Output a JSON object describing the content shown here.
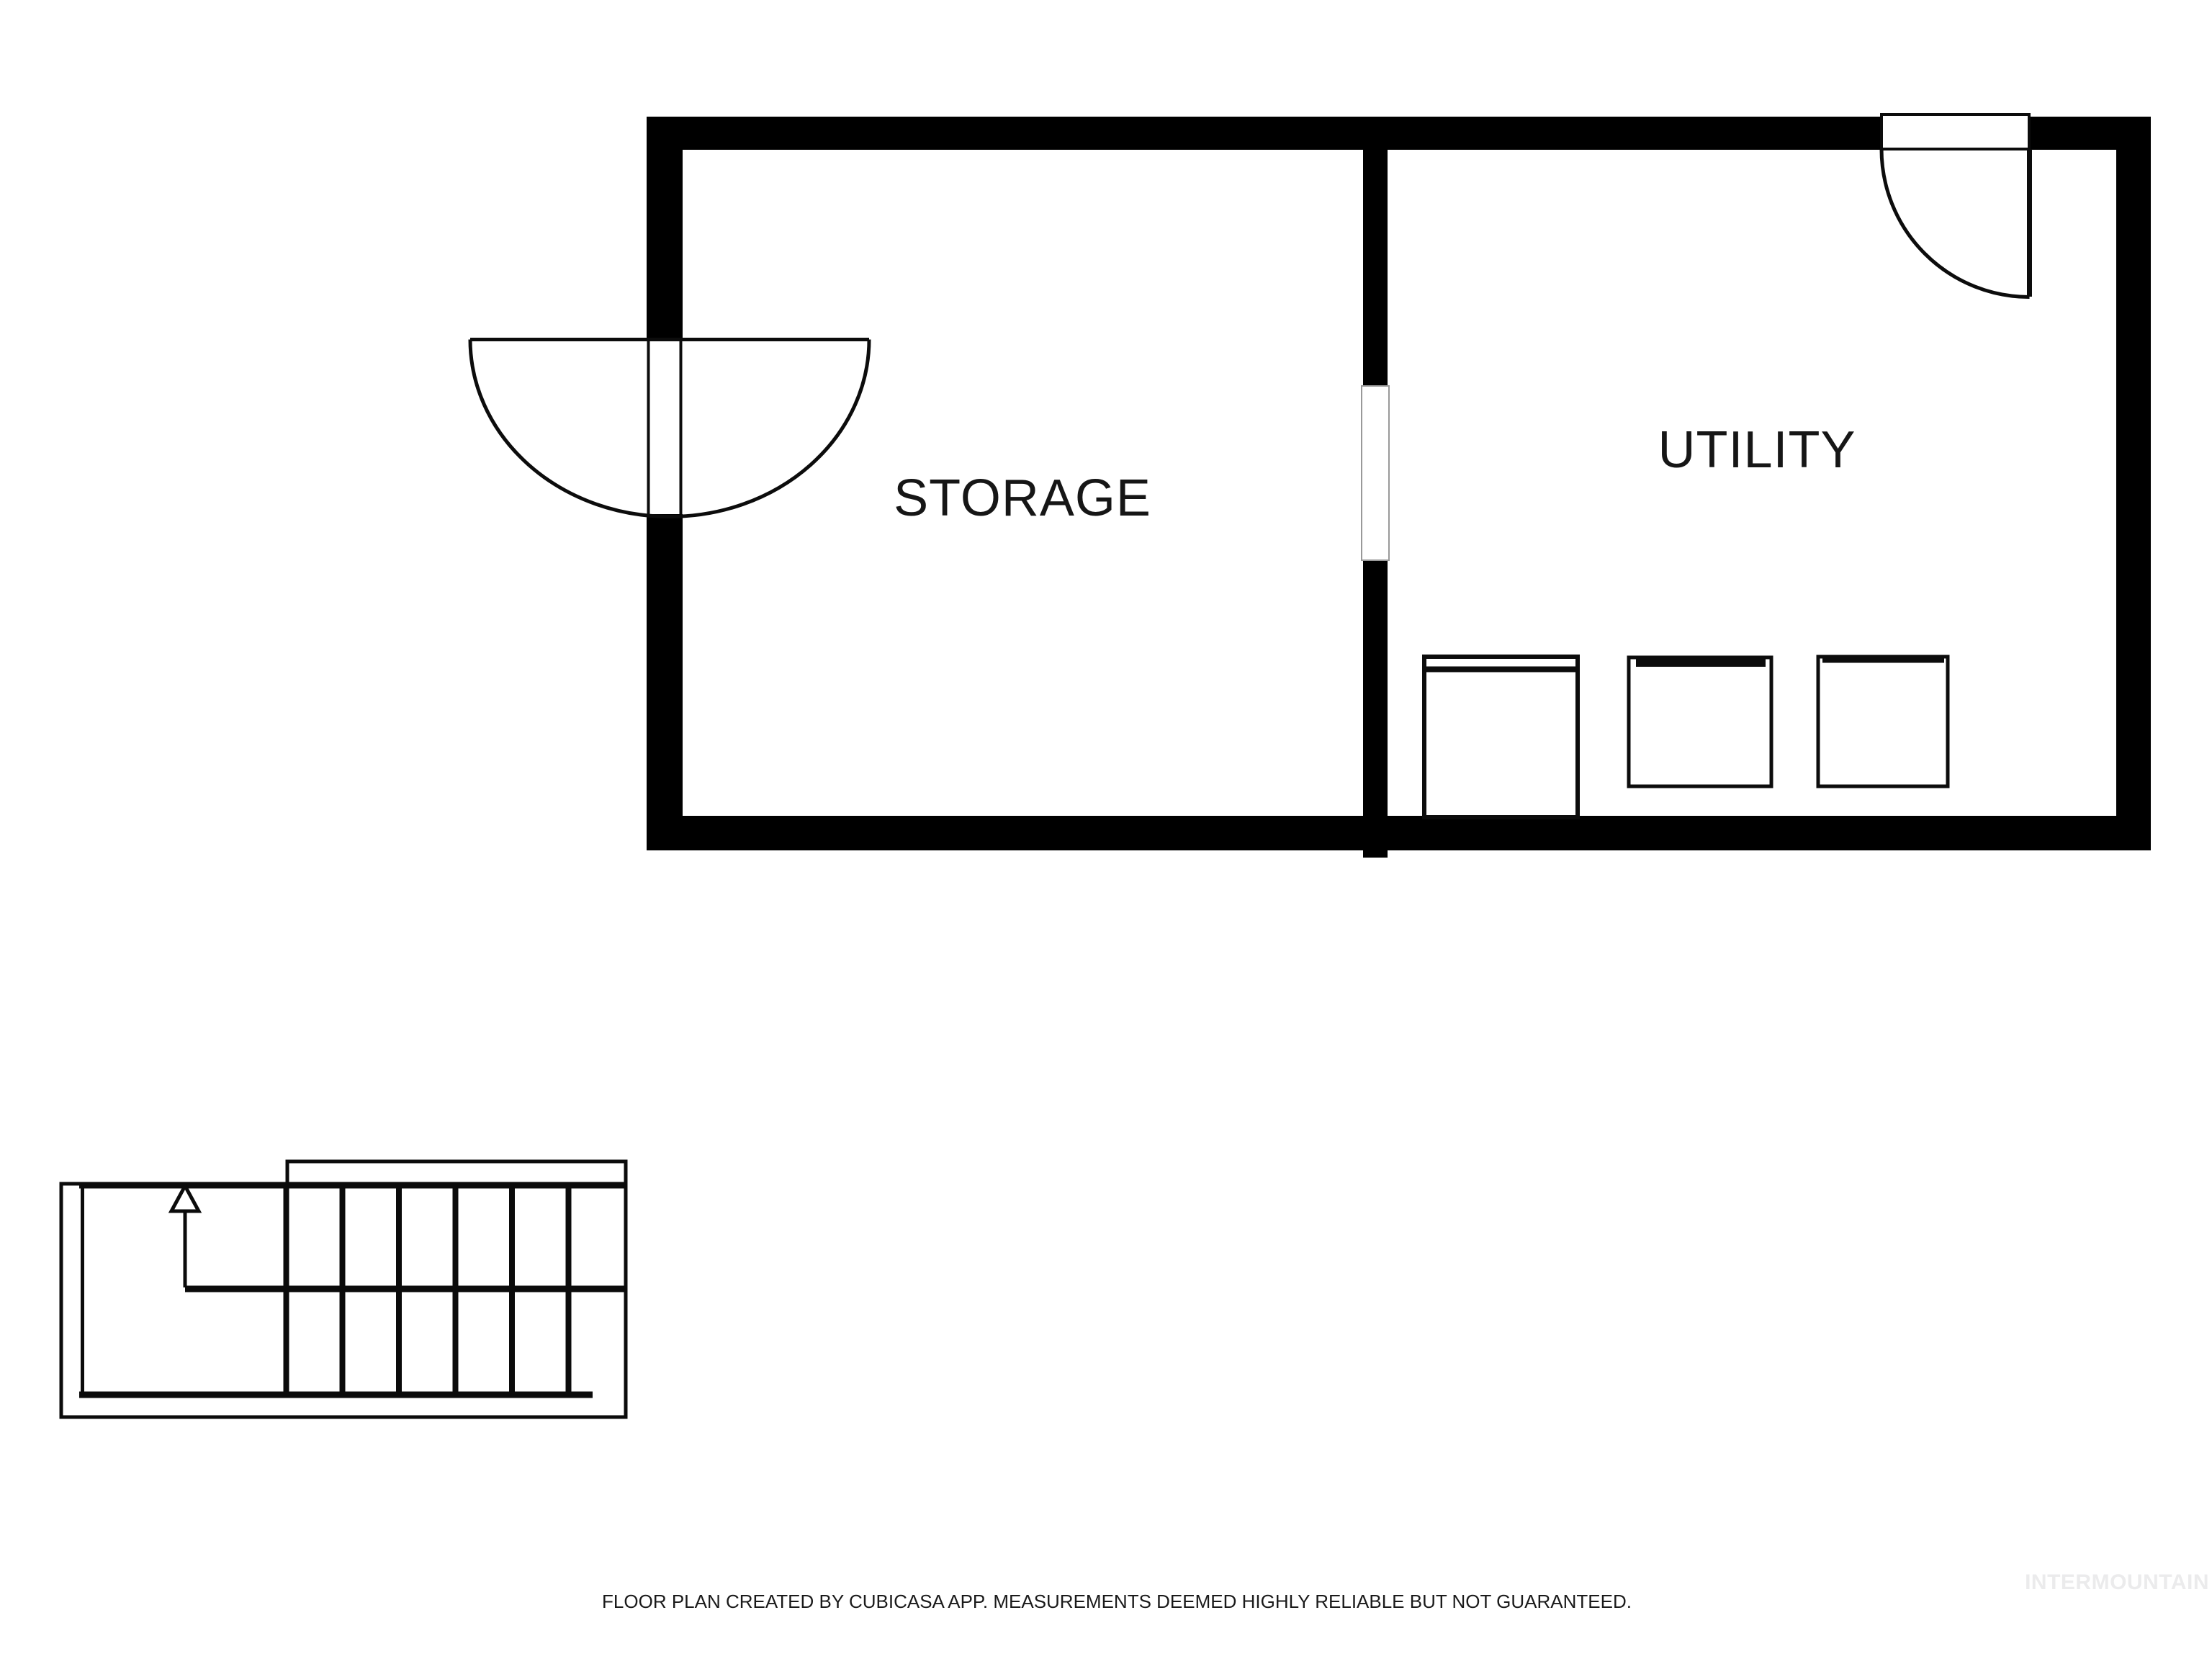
{
  "plan": {
    "rooms": [
      {
        "label": "STORAGE"
      },
      {
        "label": "UTILITY"
      }
    ],
    "symbols": {
      "storage_door": "double-swing-door-icon",
      "utility_door": "single-swing-door-icon",
      "interior_doorway": "wall-opening",
      "stairs": "staircase-with-up-arrow-icon",
      "appliances": [
        "washer-box",
        "dryer-box",
        "utility-box"
      ]
    }
  },
  "footer": {
    "disclaimer": "FLOOR PLAN CREATED BY CUBICASA APP. MEASUREMENTS DEEMED HIGHLY RELIABLE BUT NOT GUARANTEED."
  },
  "watermark": {
    "text": "INTERMOUNTAIN",
    "color": "#ebebec"
  },
  "colors": {
    "background": "#ffffff",
    "wall": "#000000",
    "line": "#0c0c0c",
    "opening_outline": "#999999"
  }
}
